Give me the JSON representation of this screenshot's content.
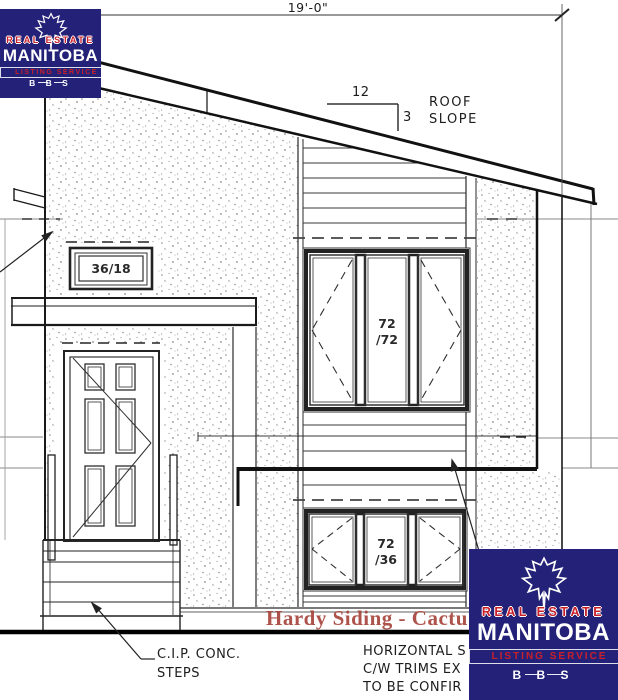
{
  "annotations": {
    "overall_width": "19'-0\"",
    "slope_run": "12",
    "slope_rise": "3",
    "roof_label_1": "ROOF",
    "roof_label_2": "SLOPE",
    "window_small": "36/18",
    "window_upper_line1": "72",
    "window_upper_line2": "/72",
    "window_lower_line1": "72",
    "window_lower_line2": "/36",
    "red_note": "Hardy Siding - Cactu",
    "steps_note_line1": "C.I.P. CONC.",
    "steps_note_line2": "STEPS",
    "siding_note_line1": "HORIZONTAL S",
    "siding_note_line2": "C/W TRIMS EX",
    "siding_note_line3": "TO BE CONFIR"
  },
  "watermark": {
    "real_estate": "REAL ESTATE",
    "name": "MANITOBA",
    "listing": "LISTING SERVICE",
    "bbs": "B B S"
  },
  "colors": {
    "logo_navy": "#242178",
    "logo_red": "#c8202a",
    "note_red": "#a8453c",
    "ink": "#1c1c1c"
  }
}
